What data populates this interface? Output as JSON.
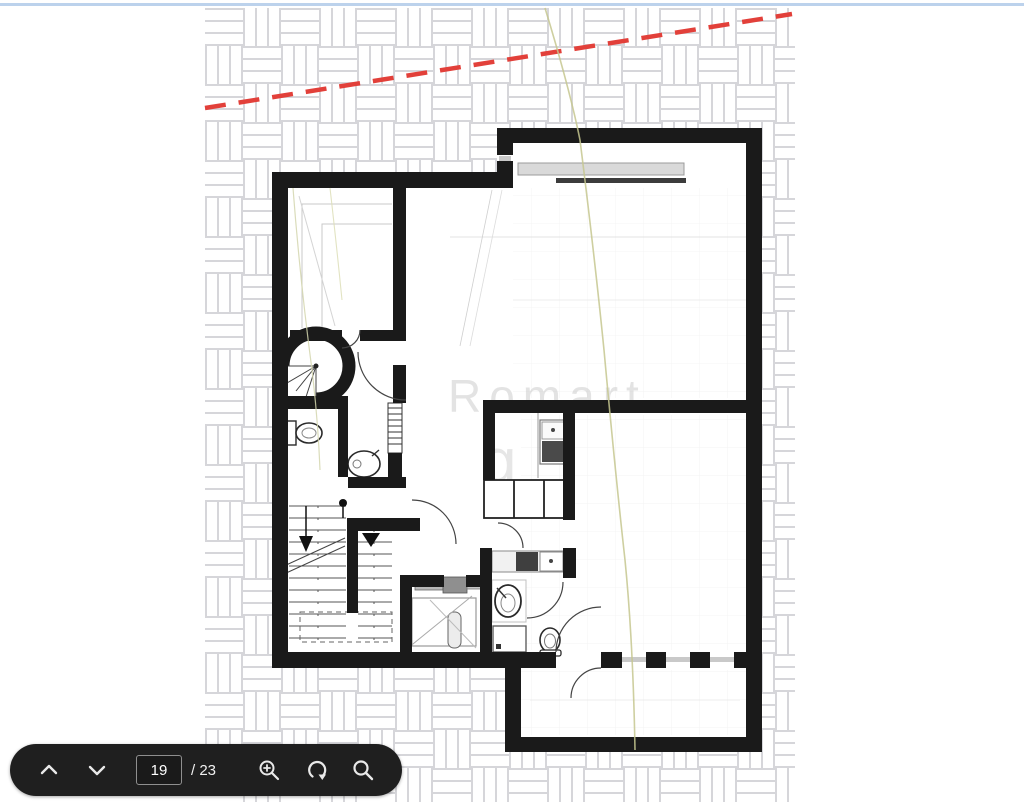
{
  "page": {
    "top_border_color": "#bcd2ec",
    "background": "#ffffff"
  },
  "plan": {
    "watermark": {
      "line1": "Romart",
      "line2": "g"
    },
    "boundary_line_color": "#e2403a",
    "hatch_line_color": "#d6d6da",
    "wall_color": "#1a1a1a",
    "contour_line_color": "#c5c78f",
    "window_bar_color": "#d9d9d9"
  },
  "toolbar": {
    "background": "#1f1f1f",
    "icon_color": "#e9e9e9",
    "page_input": {
      "value": "19"
    },
    "page_total": "/ 23",
    "icons": [
      "chevron-up",
      "chevron-down",
      "zoom-in",
      "rotate-ccw",
      "search"
    ]
  }
}
